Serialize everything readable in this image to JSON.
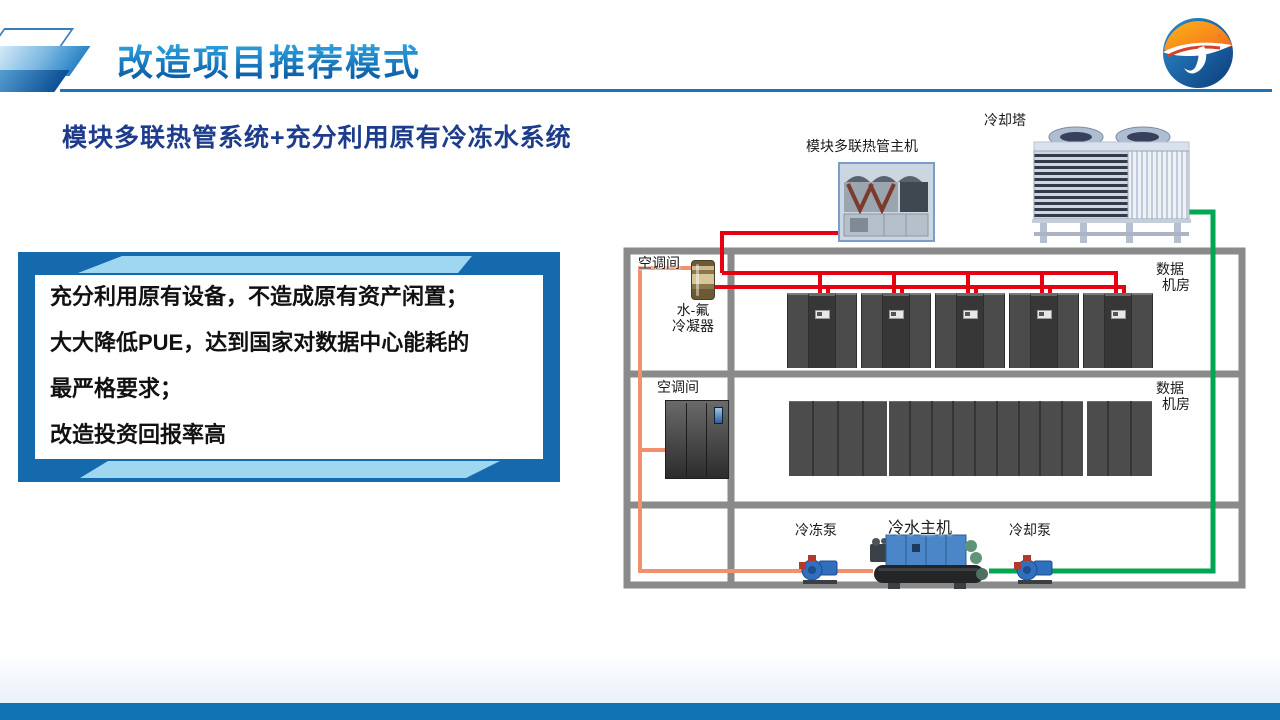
{
  "header": {
    "title": "改造项目推荐模式",
    "accent_blue": "#1f74b8"
  },
  "subtitle": "模块多联热管系统+充分利用原有冷冻水系统",
  "benefits": {
    "lines": [
      "充分利用原有设备，不造成原有资产闲置；",
      "大大降低PUE，达到国家对数据中心能耗的",
      "最严格要求；",
      "改造投资回报率高"
    ],
    "frame_dark": "#1569ad",
    "frame_light": "#9fd6f0"
  },
  "diagram": {
    "cooling_tower_label": "冷却塔",
    "heat_pipe_unit_label": "模块多联热管主机",
    "room1": {
      "ac_room_label": "空调间",
      "condenser_label_line1": "水-氟",
      "condenser_label_line2": "冷凝器",
      "dc_label_line1": "数据",
      "dc_label_line2": "机房"
    },
    "room2": {
      "ac_room_label": "空调间",
      "dc_label_line1": "数据",
      "dc_label_line2": "机房"
    },
    "plant": {
      "chiller_label": "冷水主机",
      "chilled_pump_label": "冷冻泵",
      "cooling_pump_label": "冷却泵"
    },
    "colors": {
      "pipe_red": "#e60012",
      "pipe_orange": "#f0906c",
      "pipe_green": "#00a651",
      "structure_gray": "#8a8a8a"
    }
  },
  "footer": {
    "bar_color": "#1173b4"
  }
}
